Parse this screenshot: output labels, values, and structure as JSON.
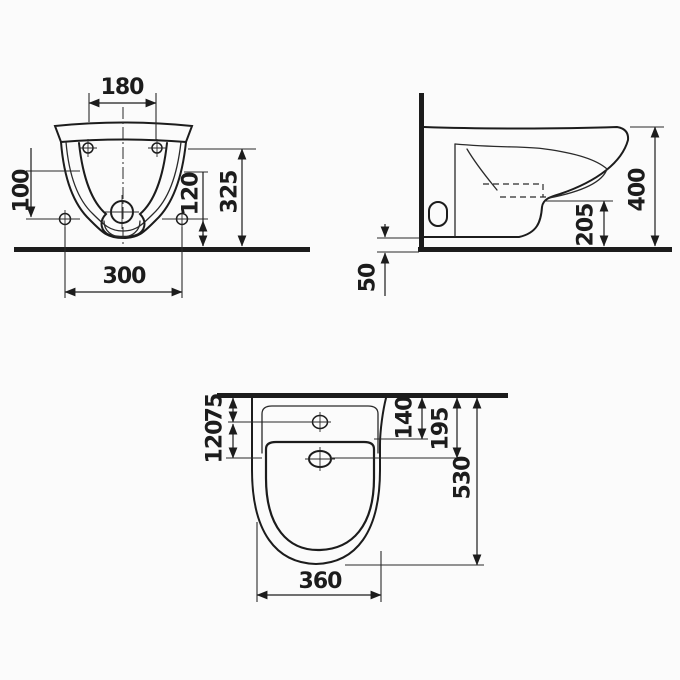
{
  "drawing": {
    "colors": {
      "line": "#1c1c1c",
      "background": "#fbfbfb"
    },
    "views": {
      "front_view": {
        "dims": {
          "mounting_holes_spacing": "180",
          "side_hole_offset": "100",
          "drain_height": "120",
          "overall_height": "325",
          "fixing_holes_spacing": "300"
        }
      },
      "side_view": {
        "dims": {
          "overall_height": "400",
          "outlet_height": "205",
          "bottom_gap": "50"
        }
      },
      "plan_view": {
        "dims": {
          "faucet_hole_from_wall": "75",
          "drain_from_faucet": "120",
          "inner_bowl_from_wall": "140",
          "drain_from_wall": "195",
          "overall_depth": "530",
          "overall_width": "360"
        }
      }
    }
  }
}
